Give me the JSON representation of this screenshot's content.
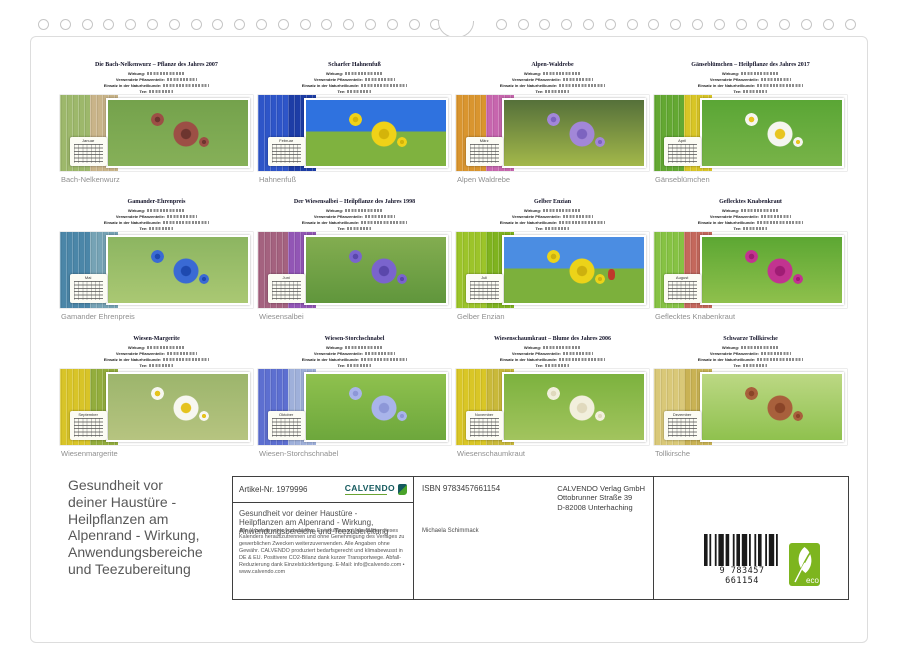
{
  "binding": {
    "hole_count": 38
  },
  "grid": {
    "detail_labels": [
      "Wirkung:",
      "Verwendete Pflanzenteile:",
      "Einsatz in der Naturheilkunde:",
      "Tee:"
    ],
    "items": [
      {
        "title": "Die Bach-Nelkenwurz – Pflanze des Jahres 2007",
        "caption": "Bach-Nelkenwurz",
        "month": "Januar",
        "colors": {
          "wood1": "#9db86b",
          "wood2": "#c9b489",
          "photo_top": "#74a24c",
          "photo_bottom": "#86b058",
          "split": false,
          "flower": "#9c4f45",
          "flower_center": "#6d352f",
          "accent": null
        }
      },
      {
        "title": "Scharfer Hahnenfuß",
        "caption": "Hahnenfuß",
        "month": "Februar",
        "colors": {
          "wood1": "#2e55c8",
          "wood2": "#1d3da6",
          "photo_top": "#2f72df",
          "photo_bottom": "#7fb23f",
          "split": true,
          "flower": "#f0d218",
          "flower_center": "#d4b40a",
          "accent": null
        }
      },
      {
        "title": "Alpen-Waldrebe",
        "caption": "Alpen Waldrebe",
        "month": "März",
        "colors": {
          "wood1": "#d9952f",
          "wood2": "#c766ae",
          "photo_top": "#55703a",
          "photo_bottom": "#a3b84a",
          "split": false,
          "flower": "#a287d8",
          "flower_center": "#7d63c0",
          "accent": null
        }
      },
      {
        "title": "Gänseblümchen – Heilpflanze des Jahres 2017",
        "caption": "Gänseblümchen",
        "month": "April",
        "colors": {
          "wood1": "#63a832",
          "wood2": "#d8c526",
          "photo_top": "#5aa635",
          "photo_bottom": "#78b348",
          "split": false,
          "flower": "#f5f5ef",
          "flower_center": "#e8c520",
          "accent": null
        }
      },
      {
        "title": "Gamander-Ehrenpreis",
        "caption": "Gamander Ehrenpreis",
        "month": "Mai",
        "colors": {
          "wood1": "#4b86a8",
          "wood2": "#76a3b5",
          "photo_top": "#8cb561",
          "photo_bottom": "#aac873",
          "split": false,
          "flower": "#3a6ad4",
          "flower_center": "#1e49b0",
          "accent": null
        }
      },
      {
        "title": "Der Wiesensalbei – Heilpflanze des Jahres 1998",
        "caption": "Wiesensalbei",
        "month": "Juni",
        "colors": {
          "wood1": "#a4627f",
          "wood2": "#9256b5",
          "photo_top": "#83ad50",
          "photo_bottom": "#60963c",
          "split": false,
          "flower": "#7a64cd",
          "flower_center": "#5a47ab",
          "accent": null
        }
      },
      {
        "title": "Gelber Enzian",
        "caption": "Gelber Enzian",
        "month": "Juli",
        "colors": {
          "wood1": "#9cc42a",
          "wood2": "#7fb31f",
          "photo_top": "#4b8de2",
          "photo_bottom": "#7cb03c",
          "split": true,
          "flower": "#ecd319",
          "flower_center": "#cdb10e",
          "accent": "#c0392b"
        }
      },
      {
        "title": "Geflecktes Knabenkraut",
        "caption": "Geflecktes Knabenkraut",
        "month": "August",
        "colors": {
          "wood1": "#86c244",
          "wood2": "#c4685c",
          "photo_top": "#5ca733",
          "photo_bottom": "#8fc04c",
          "split": false,
          "flower": "#c23390",
          "flower_center": "#a01c74",
          "accent": null
        }
      },
      {
        "title": "Wiesen-Margerite",
        "caption": "Wiesenmargerite",
        "month": "September",
        "colors": {
          "wood1": "#d8c428",
          "wood2": "#93ad3d",
          "photo_top": "#9cb56c",
          "photo_bottom": "#b6c480",
          "split": false,
          "flower": "#f7f7f0",
          "flower_center": "#e5c31e",
          "accent": null
        }
      },
      {
        "title": "Wiesen-Storchschnabel",
        "caption": "Wiesen-Storchschnabel",
        "month": "Oktober",
        "colors": {
          "wood1": "#5d6fd0",
          "wood2": "#9fb0da",
          "photo_top": "#8fc14e",
          "photo_bottom": "#6da73c",
          "split": false,
          "flower": "#a9b4ea",
          "flower_center": "#8d97d8",
          "accent": null
        }
      },
      {
        "title": "Wiesenschaumkraut – Blume des Jahres 2006",
        "caption": "Wiesenschaumkraut",
        "month": "November",
        "colors": {
          "wood1": "#d9c626",
          "wood2": "#c9b93a",
          "photo_top": "#7cb23e",
          "photo_bottom": "#a2c45e",
          "split": false,
          "flower": "#f2efdd",
          "flower_center": "#e0d9bd",
          "accent": null
        }
      },
      {
        "title": "Schwarze Tollkirsche",
        "caption": "Tollkirsche",
        "month": "Dezember",
        "colors": {
          "wood1": "#d9c878",
          "wood2": "#c9b254",
          "photo_top": "#bcd884",
          "photo_bottom": "#8fc14e",
          "split": false,
          "flower": "#a8603c",
          "flower_center": "#8a4428",
          "accent": null
        }
      }
    ]
  },
  "footer": {
    "product_title": "Gesundheit vor\ndeiner Haustüre -\nHeilpflanzen am\nAlpenrand - Wirkung,\nAnwendungsbereiche\nund Teezubereitung",
    "info_box": {
      "artikel_nr": "Artikel-Nr. 1979996",
      "brand": "CALVENDO",
      "box_title": "Gesundheit vor deiner Haustüre -\nHeilpflanzen am Alpenrand - Wirkung,\nAnwendungsbereiche und Teezubereitung",
      "legal_text": "Alle Urheberrechte vorbehalten. Es ist untersagt, die Blätter dieses Kalenders herauszutrennen und ohne Genehmigung des Verlages zu gewerblichen Zwecken weiterzuverwenden. Alle Angaben ohne Gewähr. CALVENDO produziert bedarfsgerecht und klimabewusst in DE & EU. Positivere CO2-Bilanz dank kurzer Transportwege. Abfall-Reduzierung dank Einzelstückfertigung. E-Mail: info@calvendo.com • www.calvendo.com",
      "isbn": "ISBN 9783457661154",
      "publisher": "CALVENDO Verlag GmbH\nOttobrunner Straße 39\nD-82008 Unterhaching",
      "author": "Michaela Schimmack",
      "barcode_digits": "9 783457 661154",
      "eco_label": "eco"
    }
  },
  "colors": {
    "brand_teal": "#155a5e",
    "brand_green": "#4aa32a",
    "eco_green": "#7db51f"
  }
}
